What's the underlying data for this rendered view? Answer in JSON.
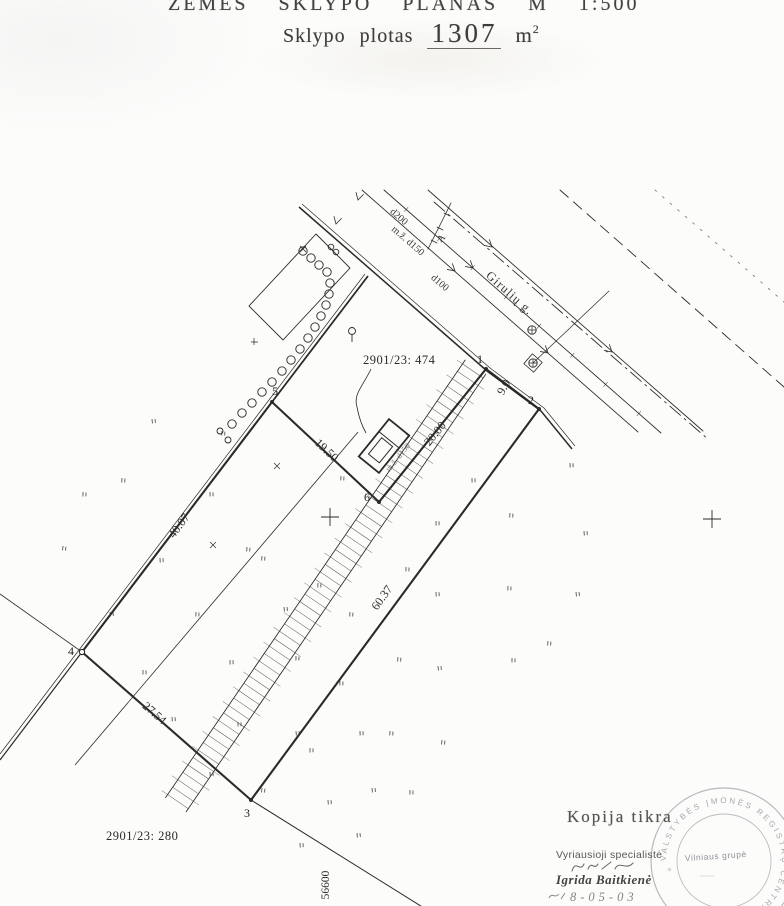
{
  "title": {
    "line1": "ŽEMĖS SKLYPO PLANAS M 1:500",
    "area_label": "Sklypo plotas",
    "area_value": "1307",
    "area_unit": "m",
    "area_exponent": "2"
  },
  "plan": {
    "parcel_label": "2901/23: 474",
    "neighbor_label": "2901/23: 280",
    "street_name": "Girulių g.",
    "coordinate_label": "56600",
    "section_marker": "A",
    "utilities": {
      "d200": "d200",
      "d150": "m.ž. d150",
      "d100": "d100",
      "strip_label": "m.ž. d150"
    },
    "points": {
      "p1": "1",
      "p2": "2",
      "p3": "3",
      "p4": "4",
      "p5": "5",
      "p6": "6"
    },
    "dimensions": {
      "d12": "9.0",
      "d23": "60.37",
      "d34": "27.54",
      "d45": "40.07",
      "d56": "19.50",
      "d61": "20.00"
    }
  },
  "certification": {
    "heading": "Kopija tikra",
    "role": "Vyriausioji specialistė",
    "name": "Igrida Baitkienė",
    "date": "8-05-03",
    "stamp_ring_text": "VALSTYBĖS ĮMONĖS REGISTRŲ CENTRAS",
    "stamp_center_text": "Vilniaus grupė"
  },
  "colors": {
    "ink": "#2b2a26",
    "faded_ink": "#6b6862",
    "stamp": "#9d9da6",
    "paper": "#fcfcfb"
  }
}
